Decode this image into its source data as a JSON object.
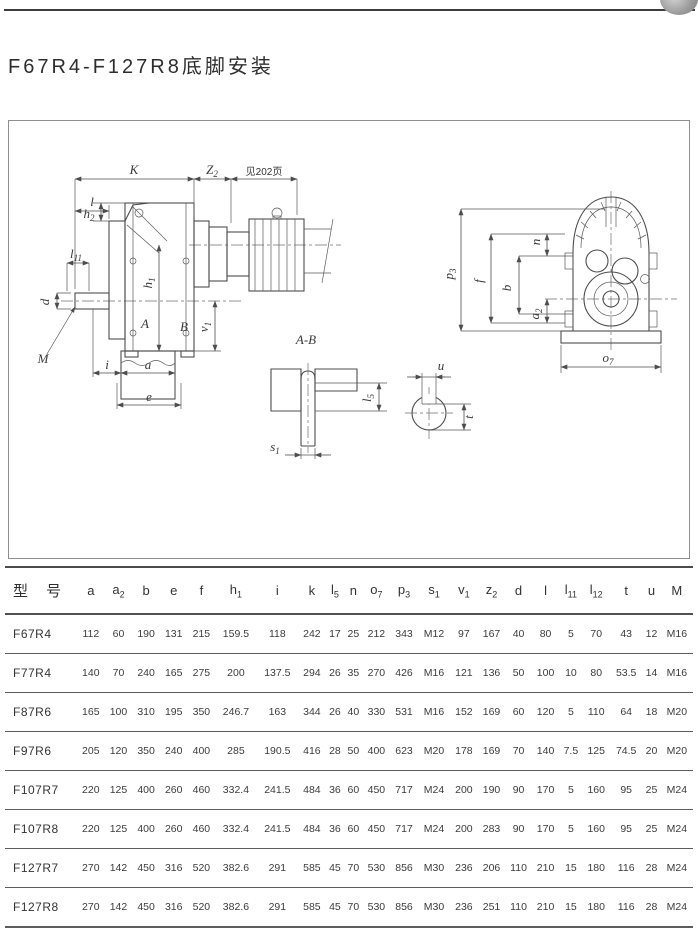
{
  "page": {
    "title": "F67R4-F127R8底脚安装"
  },
  "drawing": {
    "note": "见202页",
    "section_title": "A-B",
    "labels": {
      "k": {
        "base": "K",
        "sub": ""
      },
      "z2": {
        "base": "Z",
        "sub": "2"
      },
      "l": {
        "base": "l",
        "sub": ""
      },
      "h2": {
        "base": "h",
        "sub": "2"
      },
      "l11": {
        "base": "l",
        "sub": "11"
      },
      "d": {
        "base": "d",
        "sub": ""
      },
      "m": {
        "base": "M",
        "sub": ""
      },
      "h1": {
        "base": "h",
        "sub": "1"
      },
      "a_mark": {
        "base": "A",
        "sub": ""
      },
      "b_mark": {
        "base": "B",
        "sub": ""
      },
      "v1": {
        "base": "v",
        "sub": "1"
      },
      "i": {
        "base": "i",
        "sub": ""
      },
      "a": {
        "base": "a",
        "sub": ""
      },
      "e": {
        "base": "e",
        "sub": ""
      },
      "l5": {
        "base": "l",
        "sub": "5"
      },
      "s1": {
        "base": "s",
        "sub": "1"
      },
      "n": {
        "base": "n",
        "sub": ""
      },
      "p3": {
        "base": "p",
        "sub": "3"
      },
      "f": {
        "base": "f",
        "sub": ""
      },
      "b": {
        "base": "b",
        "sub": ""
      },
      "a2": {
        "base": "a",
        "sub": "2"
      },
      "o7": {
        "base": "o",
        "sub": "7"
      },
      "u": {
        "base": "u",
        "sub": ""
      },
      "t": {
        "base": "t",
        "sub": ""
      }
    }
  },
  "table": {
    "headers": [
      {
        "base": "型 号",
        "sub": ""
      },
      {
        "base": "a",
        "sub": ""
      },
      {
        "base": "a",
        "sub": "2"
      },
      {
        "base": "b",
        "sub": ""
      },
      {
        "base": "e",
        "sub": ""
      },
      {
        "base": "f",
        "sub": ""
      },
      {
        "base": "h",
        "sub": "1"
      },
      {
        "base": "i",
        "sub": ""
      },
      {
        "base": "k",
        "sub": ""
      },
      {
        "base": "l",
        "sub": "5"
      },
      {
        "base": "n",
        "sub": ""
      },
      {
        "base": "o",
        "sub": "7"
      },
      {
        "base": "p",
        "sub": "3"
      },
      {
        "base": "s",
        "sub": "1"
      },
      {
        "base": "v",
        "sub": "1"
      },
      {
        "base": "z",
        "sub": "2"
      },
      {
        "base": "d",
        "sub": ""
      },
      {
        "base": "l",
        "sub": ""
      },
      {
        "base": "l",
        "sub": "11"
      },
      {
        "base": "l",
        "sub": "12"
      },
      {
        "base": "t",
        "sub": ""
      },
      {
        "base": "u",
        "sub": ""
      },
      {
        "base": "M",
        "sub": ""
      }
    ],
    "rows": [
      {
        "model": "F67R4",
        "values": [
          "112",
          "60",
          "190",
          "131",
          "215",
          "159.5",
          "118",
          "242",
          "17",
          "25",
          "212",
          "343",
          "M12",
          "97",
          "167",
          "40",
          "80",
          "5",
          "70",
          "43",
          "12",
          "M16"
        ]
      },
      {
        "model": "F77R4",
        "values": [
          "140",
          "70",
          "240",
          "165",
          "275",
          "200",
          "137.5",
          "294",
          "26",
          "35",
          "270",
          "426",
          "M16",
          "121",
          "136",
          "50",
          "100",
          "10",
          "80",
          "53.5",
          "14",
          "M16"
        ]
      },
      {
        "model": "F87R6",
        "values": [
          "165",
          "100",
          "310",
          "195",
          "350",
          "246.7",
          "163",
          "344",
          "26",
          "40",
          "330",
          "531",
          "M16",
          "152",
          "169",
          "60",
          "120",
          "5",
          "110",
          "64",
          "18",
          "M20"
        ]
      },
      {
        "model": "F97R6",
        "values": [
          "205",
          "120",
          "350",
          "240",
          "400",
          "285",
          "190.5",
          "416",
          "28",
          "50",
          "400",
          "623",
          "M20",
          "178",
          "169",
          "70",
          "140",
          "7.5",
          "125",
          "74.5",
          "20",
          "M20"
        ]
      },
      {
        "model": "F107R7",
        "values": [
          "220",
          "125",
          "400",
          "260",
          "460",
          "332.4",
          "241.5",
          "484",
          "36",
          "60",
          "450",
          "717",
          "M24",
          "200",
          "190",
          "90",
          "170",
          "5",
          "160",
          "95",
          "25",
          "M24"
        ]
      },
      {
        "model": "F107R8",
        "values": [
          "220",
          "125",
          "400",
          "260",
          "460",
          "332.4",
          "241.5",
          "484",
          "36",
          "60",
          "450",
          "717",
          "M24",
          "200",
          "283",
          "90",
          "170",
          "5",
          "160",
          "95",
          "25",
          "M24"
        ]
      },
      {
        "model": "F127R7",
        "values": [
          "270",
          "142",
          "450",
          "316",
          "520",
          "382.6",
          "291",
          "585",
          "45",
          "70",
          "530",
          "856",
          "M30",
          "236",
          "206",
          "110",
          "210",
          "15",
          "180",
          "116",
          "28",
          "M24"
        ]
      },
      {
        "model": "F127R8",
        "values": [
          "270",
          "142",
          "450",
          "316",
          "520",
          "382.6",
          "291",
          "585",
          "45",
          "70",
          "530",
          "856",
          "M30",
          "236",
          "251",
          "110",
          "210",
          "15",
          "180",
          "116",
          "28",
          "M24"
        ]
      }
    ]
  }
}
